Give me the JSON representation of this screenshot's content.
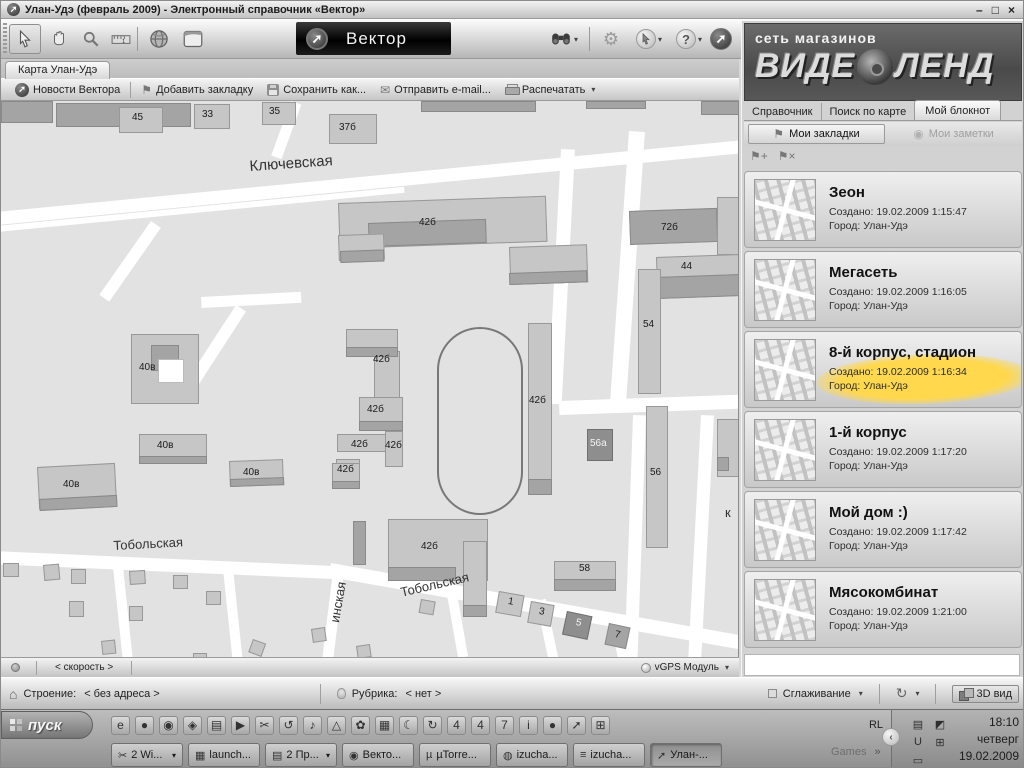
{
  "window": {
    "title": "Улан-Удэ (февраль 2009) - Электронный справочник «Вектор»",
    "controls": {
      "minimize": "–",
      "restore": "□",
      "close": "×"
    }
  },
  "brand": {
    "logo_text": "Вектор",
    "arrow_glyph": "➚"
  },
  "map_tab": {
    "label": "Карта Улан-Удэ"
  },
  "actions_toolbar": {
    "items": [
      {
        "label": "Новости Вектора"
      },
      {
        "label": "Добавить закладку"
      },
      {
        "label": "Сохранить как..."
      },
      {
        "label": "Отправить e-mail..."
      },
      {
        "label": "Распечатать"
      }
    ],
    "print_caret": "▾"
  },
  "map": {
    "streets": [
      {
        "x": -15,
        "y": 112,
        "w": 790,
        "h": 13,
        "r": -5.5
      },
      {
        "x": -15,
        "y": 126,
        "w": 420,
        "h": 6,
        "r": -5.5
      },
      {
        "x": 290,
        "y": 0,
        "w": 11,
        "h": 58,
        "r": 20
      },
      {
        "x": 150,
        "y": 120,
        "w": 12,
        "h": 90,
        "r": 35
      },
      {
        "x": 200,
        "y": 196,
        "w": 100,
        "h": 11,
        "r": -3
      },
      {
        "x": 235,
        "y": 204,
        "w": 12,
        "h": 110,
        "r": 33
      },
      {
        "x": 560,
        "y": 48,
        "w": 14,
        "h": 255,
        "r": 3
      },
      {
        "x": 628,
        "y": 30,
        "w": 16,
        "h": 275,
        "r": 4
      },
      {
        "x": 558,
        "y": 300,
        "w": 182,
        "h": 14,
        "r": -2
      },
      {
        "x": 632,
        "y": 314,
        "w": 13,
        "h": 250,
        "r": 2
      },
      {
        "x": 700,
        "y": 314,
        "w": 13,
        "h": 246,
        "r": 3
      },
      {
        "x": -10,
        "y": 450,
        "w": 358,
        "h": 13,
        "r": 2.5
      },
      {
        "x": 330,
        "y": 462,
        "w": 430,
        "h": 14,
        "r": 10
      },
      {
        "x": 332,
        "y": 470,
        "w": 11,
        "h": 95,
        "r": 7
      },
      {
        "x": 112,
        "y": 466,
        "w": 10,
        "h": 92,
        "r": -6
      },
      {
        "x": 222,
        "y": 468,
        "w": 10,
        "h": 92,
        "r": -6
      },
      {
        "x": 445,
        "y": 488,
        "w": 10,
        "h": 70,
        "r": -10
      },
      {
        "x": 535,
        "y": 500,
        "w": 10,
        "h": 60,
        "r": -12
      },
      {
        "x": 608,
        "y": 515,
        "w": 10,
        "h": 48,
        "r": -12
      }
    ],
    "buildings": [
      {
        "x": 0,
        "y": 0,
        "w": 52,
        "h": 22,
        "d": 1
      },
      {
        "x": 55,
        "y": 2,
        "w": 135,
        "h": 24,
        "d": 1
      },
      {
        "x": 118,
        "y": 6,
        "w": 44,
        "h": 26
      },
      {
        "x": 193,
        "y": 3,
        "w": 36,
        "h": 25
      },
      {
        "x": 261,
        "y": 1,
        "w": 34,
        "h": 23
      },
      {
        "x": 328,
        "y": 13,
        "w": 48,
        "h": 30
      },
      {
        "x": 420,
        "y": 0,
        "w": 115,
        "h": 11,
        "d": 1
      },
      {
        "x": 585,
        "y": 0,
        "w": 60,
        "h": 8,
        "d": 1
      },
      {
        "x": 700,
        "y": 0,
        "w": 38,
        "h": 14,
        "d": 1
      },
      {
        "x": 337,
        "y": 102,
        "w": 208,
        "h": 46,
        "r": -2
      },
      {
        "x": 367,
        "y": 122,
        "w": 118,
        "h": 24,
        "d": 1,
        "r": -2
      },
      {
        "x": 508,
        "y": 146,
        "w": 78,
        "h": 38,
        "r": -2
      },
      {
        "x": 508,
        "y": 172,
        "w": 78,
        "h": 12,
        "d": 1,
        "r": -2
      },
      {
        "x": 337,
        "y": 134,
        "w": 46,
        "h": 26,
        "r": -2
      },
      {
        "x": 339,
        "y": 150,
        "w": 44,
        "h": 12,
        "d": 1,
        "r": -2
      },
      {
        "x": 628,
        "y": 110,
        "w": 88,
        "h": 34,
        "d": 1,
        "r": -2
      },
      {
        "x": 716,
        "y": 96,
        "w": 22,
        "h": 58
      },
      {
        "x": 655,
        "y": 156,
        "w": 83,
        "h": 22,
        "r": -2
      },
      {
        "x": 655,
        "y": 176,
        "w": 83,
        "h": 22,
        "d": 1,
        "r": -2
      },
      {
        "x": 637,
        "y": 168,
        "w": 23,
        "h": 125
      },
      {
        "x": 130,
        "y": 233,
        "w": 68,
        "h": 70
      },
      {
        "x": 150,
        "y": 244,
        "w": 28,
        "h": 26,
        "d": 1
      },
      {
        "x": 157,
        "y": 258,
        "w": 26,
        "h": 24,
        "white": true
      },
      {
        "x": 345,
        "y": 228,
        "w": 52,
        "h": 28
      },
      {
        "x": 373,
        "y": 250,
        "w": 26,
        "h": 52
      },
      {
        "x": 345,
        "y": 246,
        "w": 52,
        "h": 10,
        "d": 1
      },
      {
        "x": 358,
        "y": 296,
        "w": 44,
        "h": 30
      },
      {
        "x": 358,
        "y": 320,
        "w": 44,
        "h": 10,
        "d": 1
      },
      {
        "x": 336,
        "y": 333,
        "w": 50,
        "h": 18
      },
      {
        "x": 384,
        "y": 330,
        "w": 18,
        "h": 36
      },
      {
        "x": 335,
        "y": 358,
        "w": 24,
        "h": 22
      },
      {
        "x": 335,
        "y": 374,
        "w": 24,
        "h": 8,
        "d": 1
      },
      {
        "x": 527,
        "y": 222,
        "w": 24,
        "h": 172
      },
      {
        "x": 527,
        "y": 378,
        "w": 24,
        "h": 16,
        "d": 1
      },
      {
        "x": 586,
        "y": 328,
        "w": 26,
        "h": 32,
        "d": 2
      },
      {
        "x": 645,
        "y": 305,
        "w": 22,
        "h": 142
      },
      {
        "x": 716,
        "y": 318,
        "w": 22,
        "h": 58
      },
      {
        "x": 716,
        "y": 356,
        "w": 12,
        "h": 14,
        "d": 1
      },
      {
        "x": 138,
        "y": 333,
        "w": 68,
        "h": 26
      },
      {
        "x": 138,
        "y": 355,
        "w": 68,
        "h": 8,
        "d": 1
      },
      {
        "x": 36,
        "y": 366,
        "w": 78,
        "h": 42,
        "r": -3
      },
      {
        "x": 38,
        "y": 398,
        "w": 78,
        "h": 12,
        "d": 1,
        "r": -3
      },
      {
        "x": 228,
        "y": 360,
        "w": 54,
        "h": 25,
        "r": -2
      },
      {
        "x": 229,
        "y": 378,
        "w": 54,
        "h": 8,
        "d": 1,
        "r": -2
      },
      {
        "x": 331,
        "y": 362,
        "w": 28,
        "h": 26
      },
      {
        "x": 331,
        "y": 380,
        "w": 28,
        "h": 8,
        "d": 1
      },
      {
        "x": 352,
        "y": 420,
        "w": 13,
        "h": 44,
        "d": 1
      },
      {
        "x": 387,
        "y": 418,
        "w": 100,
        "h": 62
      },
      {
        "x": 387,
        "y": 466,
        "w": 68,
        "h": 14,
        "d": 1
      },
      {
        "x": 462,
        "y": 440,
        "w": 24,
        "h": 76
      },
      {
        "x": 462,
        "y": 504,
        "w": 24,
        "h": 12,
        "d": 1
      },
      {
        "x": 553,
        "y": 460,
        "w": 62,
        "h": 30
      },
      {
        "x": 553,
        "y": 478,
        "w": 62,
        "h": 12,
        "d": 1
      },
      {
        "x": 498,
        "y": 490,
        "w": 26,
        "h": 22,
        "r": 10
      },
      {
        "x": 530,
        "y": 500,
        "w": 24,
        "h": 22,
        "r": 10
      },
      {
        "x": 566,
        "y": 510,
        "w": 26,
        "h": 24,
        "r": 12,
        "d": 2
      },
      {
        "x": 608,
        "y": 522,
        "w": 22,
        "h": 22,
        "r": 12,
        "d": 1
      },
      {
        "x": 2,
        "y": 462,
        "w": 16,
        "h": 14
      },
      {
        "x": 42,
        "y": 464,
        "w": 16,
        "h": 16,
        "r": -5
      },
      {
        "x": 70,
        "y": 468,
        "w": 15,
        "h": 15
      },
      {
        "x": 128,
        "y": 470,
        "w": 16,
        "h": 14,
        "r": -4
      },
      {
        "x": 172,
        "y": 474,
        "w": 15,
        "h": 14
      },
      {
        "x": 68,
        "y": 500,
        "w": 15,
        "h": 16
      },
      {
        "x": 128,
        "y": 505,
        "w": 14,
        "h": 15
      },
      {
        "x": 100,
        "y": 540,
        "w": 14,
        "h": 14,
        "r": -6
      },
      {
        "x": 205,
        "y": 490,
        "w": 15,
        "h": 14
      },
      {
        "x": 252,
        "y": 538,
        "w": 14,
        "h": 14,
        "r": 20
      },
      {
        "x": 192,
        "y": 552,
        "w": 14,
        "h": 13
      },
      {
        "x": 310,
        "y": 528,
        "w": 14,
        "h": 14,
        "r": -8
      },
      {
        "x": 355,
        "y": 545,
        "w": 14,
        "h": 13,
        "r": -8
      },
      {
        "x": 420,
        "y": 498,
        "w": 15,
        "h": 14,
        "r": 10
      }
    ],
    "labels": [
      {
        "text": "45",
        "x": 131,
        "y": 11
      },
      {
        "text": "33",
        "x": 201,
        "y": 8
      },
      {
        "text": "35",
        "x": 268,
        "y": 5
      },
      {
        "text": "37б",
        "x": 338,
        "y": 21
      },
      {
        "text": "42б",
        "x": 418,
        "y": 116
      },
      {
        "text": "72б",
        "x": 660,
        "y": 121
      },
      {
        "text": "44",
        "x": 680,
        "y": 160
      },
      {
        "text": "54",
        "x": 642,
        "y": 218
      },
      {
        "text": "40в",
        "x": 138,
        "y": 261
      },
      {
        "text": "42б",
        "x": 372,
        "y": 253
      },
      {
        "text": "42б",
        "x": 366,
        "y": 303
      },
      {
        "text": "42б",
        "x": 350,
        "y": 338
      },
      {
        "text": "42б",
        "x": 384,
        "y": 339
      },
      {
        "text": "42б",
        "x": 336,
        "y": 363
      },
      {
        "text": "42б",
        "x": 528,
        "y": 294
      },
      {
        "text": "56а",
        "x": 589,
        "y": 337,
        "cls": "white"
      },
      {
        "text": "56",
        "x": 649,
        "y": 366
      },
      {
        "text": "40в",
        "x": 156,
        "y": 339
      },
      {
        "text": "40в",
        "x": 62,
        "y": 378
      },
      {
        "text": "40в",
        "x": 242,
        "y": 366
      },
      {
        "text": "42б",
        "x": 420,
        "y": 440
      },
      {
        "text": "58",
        "x": 578,
        "y": 462
      },
      {
        "text": "1",
        "x": 508,
        "y": 495,
        "r": 10
      },
      {
        "text": "3",
        "x": 539,
        "y": 505,
        "r": 10
      },
      {
        "text": "5",
        "x": 576,
        "y": 516,
        "r": 12,
        "cls": "white"
      },
      {
        "text": "7",
        "x": 615,
        "y": 528,
        "r": 12
      },
      {
        "text": "Ключевская",
        "x": 248,
        "y": 57,
        "size": 15,
        "r": -4,
        "cls": "street"
      },
      {
        "text": "Тобольская",
        "x": 112,
        "y": 437,
        "size": 13,
        "r": -3,
        "cls": "street"
      },
      {
        "text": "Тобольская",
        "x": 398,
        "y": 484,
        "size": 13,
        "r": -13,
        "cls": "street"
      },
      {
        "text": "инская",
        "x": 326,
        "y": 520,
        "size": 13,
        "r": -80,
        "cls": "street"
      },
      {
        "text": "к",
        "x": 724,
        "y": 404,
        "size": 13,
        "cls": "street"
      }
    ]
  },
  "map_statusbar": {
    "speed_label": "< скорость >",
    "gps_label": "vGPS Модуль",
    "caret": "▾"
  },
  "statusbar": {
    "building_label": "Строение:",
    "building_value": "< без адреса >",
    "rubric_label": "Рубрика:",
    "rubric_value": "< нет >",
    "smoothing_label": "Сглаживание",
    "sync_glyph": "↻",
    "view3d_label": "3D вид",
    "caret": "▾"
  },
  "sidebar": {
    "brand_top": "сеть магазинов",
    "brand_word1": "ВИДЕ",
    "brand_word2": "ЛЕНД",
    "tabs": {
      "directory": "Справочник",
      "map_search": "Поиск по карте",
      "notebook": "Мой блокнот"
    },
    "subtabs": {
      "bookmarks": "Мои закладки",
      "notes": "Мои заметки"
    },
    "icons": {
      "bookmark_flag": "⚑",
      "note_pin": "◉",
      "add_bookmark": "⚑+",
      "delete_bookmark": "⚑×"
    },
    "bookmarks": [
      {
        "title": "Зеон",
        "created": "Создано: 19.02.2009 1:15:47",
        "city": "Город: Улан-Удэ"
      },
      {
        "title": "Мегасеть",
        "created": "Создано: 19.02.2009 1:16:05",
        "city": "Город: Улан-Удэ"
      },
      {
        "title": "8-й корпус, стадион",
        "created": "Создано: 19.02.2009 1:16:34",
        "city": "Город: Улан-Удэ",
        "highlighted": true
      },
      {
        "title": "1-й корпус",
        "created": "Создано: 19.02.2009 1:17:20",
        "city": "Город: Улан-Удэ"
      },
      {
        "title": "Мой дом :)",
        "created": "Создано: 19.02.2009 1:17:42",
        "city": "Город: Улан-Удэ"
      },
      {
        "title": "Мясокомбинат",
        "created": "Создано: 19.02.2009 1:21:00",
        "city": "Город: Улан-Удэ"
      }
    ],
    "highlight_color": "#ffd84e"
  },
  "taskbar": {
    "start_label": "пуск",
    "quick_launch": [
      {
        "glyph": "e"
      },
      {
        "glyph": "●"
      },
      {
        "glyph": "◉"
      },
      {
        "glyph": "◈"
      },
      {
        "glyph": "▤"
      },
      {
        "glyph": "▶"
      },
      {
        "glyph": "✂"
      },
      {
        "glyph": "↺"
      },
      {
        "glyph": "♪"
      },
      {
        "glyph": "△"
      },
      {
        "glyph": "✿"
      },
      {
        "glyph": "▦"
      },
      {
        "glyph": "☾"
      },
      {
        "glyph": "↻"
      },
      {
        "glyph": "4"
      },
      {
        "glyph": "4"
      },
      {
        "glyph": "7"
      },
      {
        "glyph": "i"
      },
      {
        "glyph": "●"
      },
      {
        "glyph": "➚"
      },
      {
        "glyph": "⊞"
      }
    ],
    "windows": [
      {
        "icon": "✂",
        "label": "2 Wi...",
        "caret": true
      },
      {
        "icon": "▦",
        "label": "launch..."
      },
      {
        "icon": "▤",
        "label": "2 Пр...",
        "caret": true
      },
      {
        "icon": "◉",
        "label": "Векто..."
      },
      {
        "icon": "µ",
        "label": "µTorre..."
      },
      {
        "icon": "◍",
        "label": "izucha..."
      },
      {
        "icon": "≡",
        "label": "izucha..."
      },
      {
        "icon": "➚",
        "label": "Улан-...",
        "active": true
      }
    ],
    "games_label": "Games",
    "games_chevron": "»",
    "lang_indicator": "RL",
    "tray_icons": [
      {
        "glyph": "▤"
      },
      {
        "glyph": "◩"
      },
      {
        "glyph": "U"
      },
      {
        "glyph": "⊞"
      },
      {
        "glyph": "▭"
      }
    ],
    "tray_chevron": "‹",
    "clock": {
      "time": "18:10",
      "day": "четверг",
      "date": "19.02.2009"
    }
  }
}
